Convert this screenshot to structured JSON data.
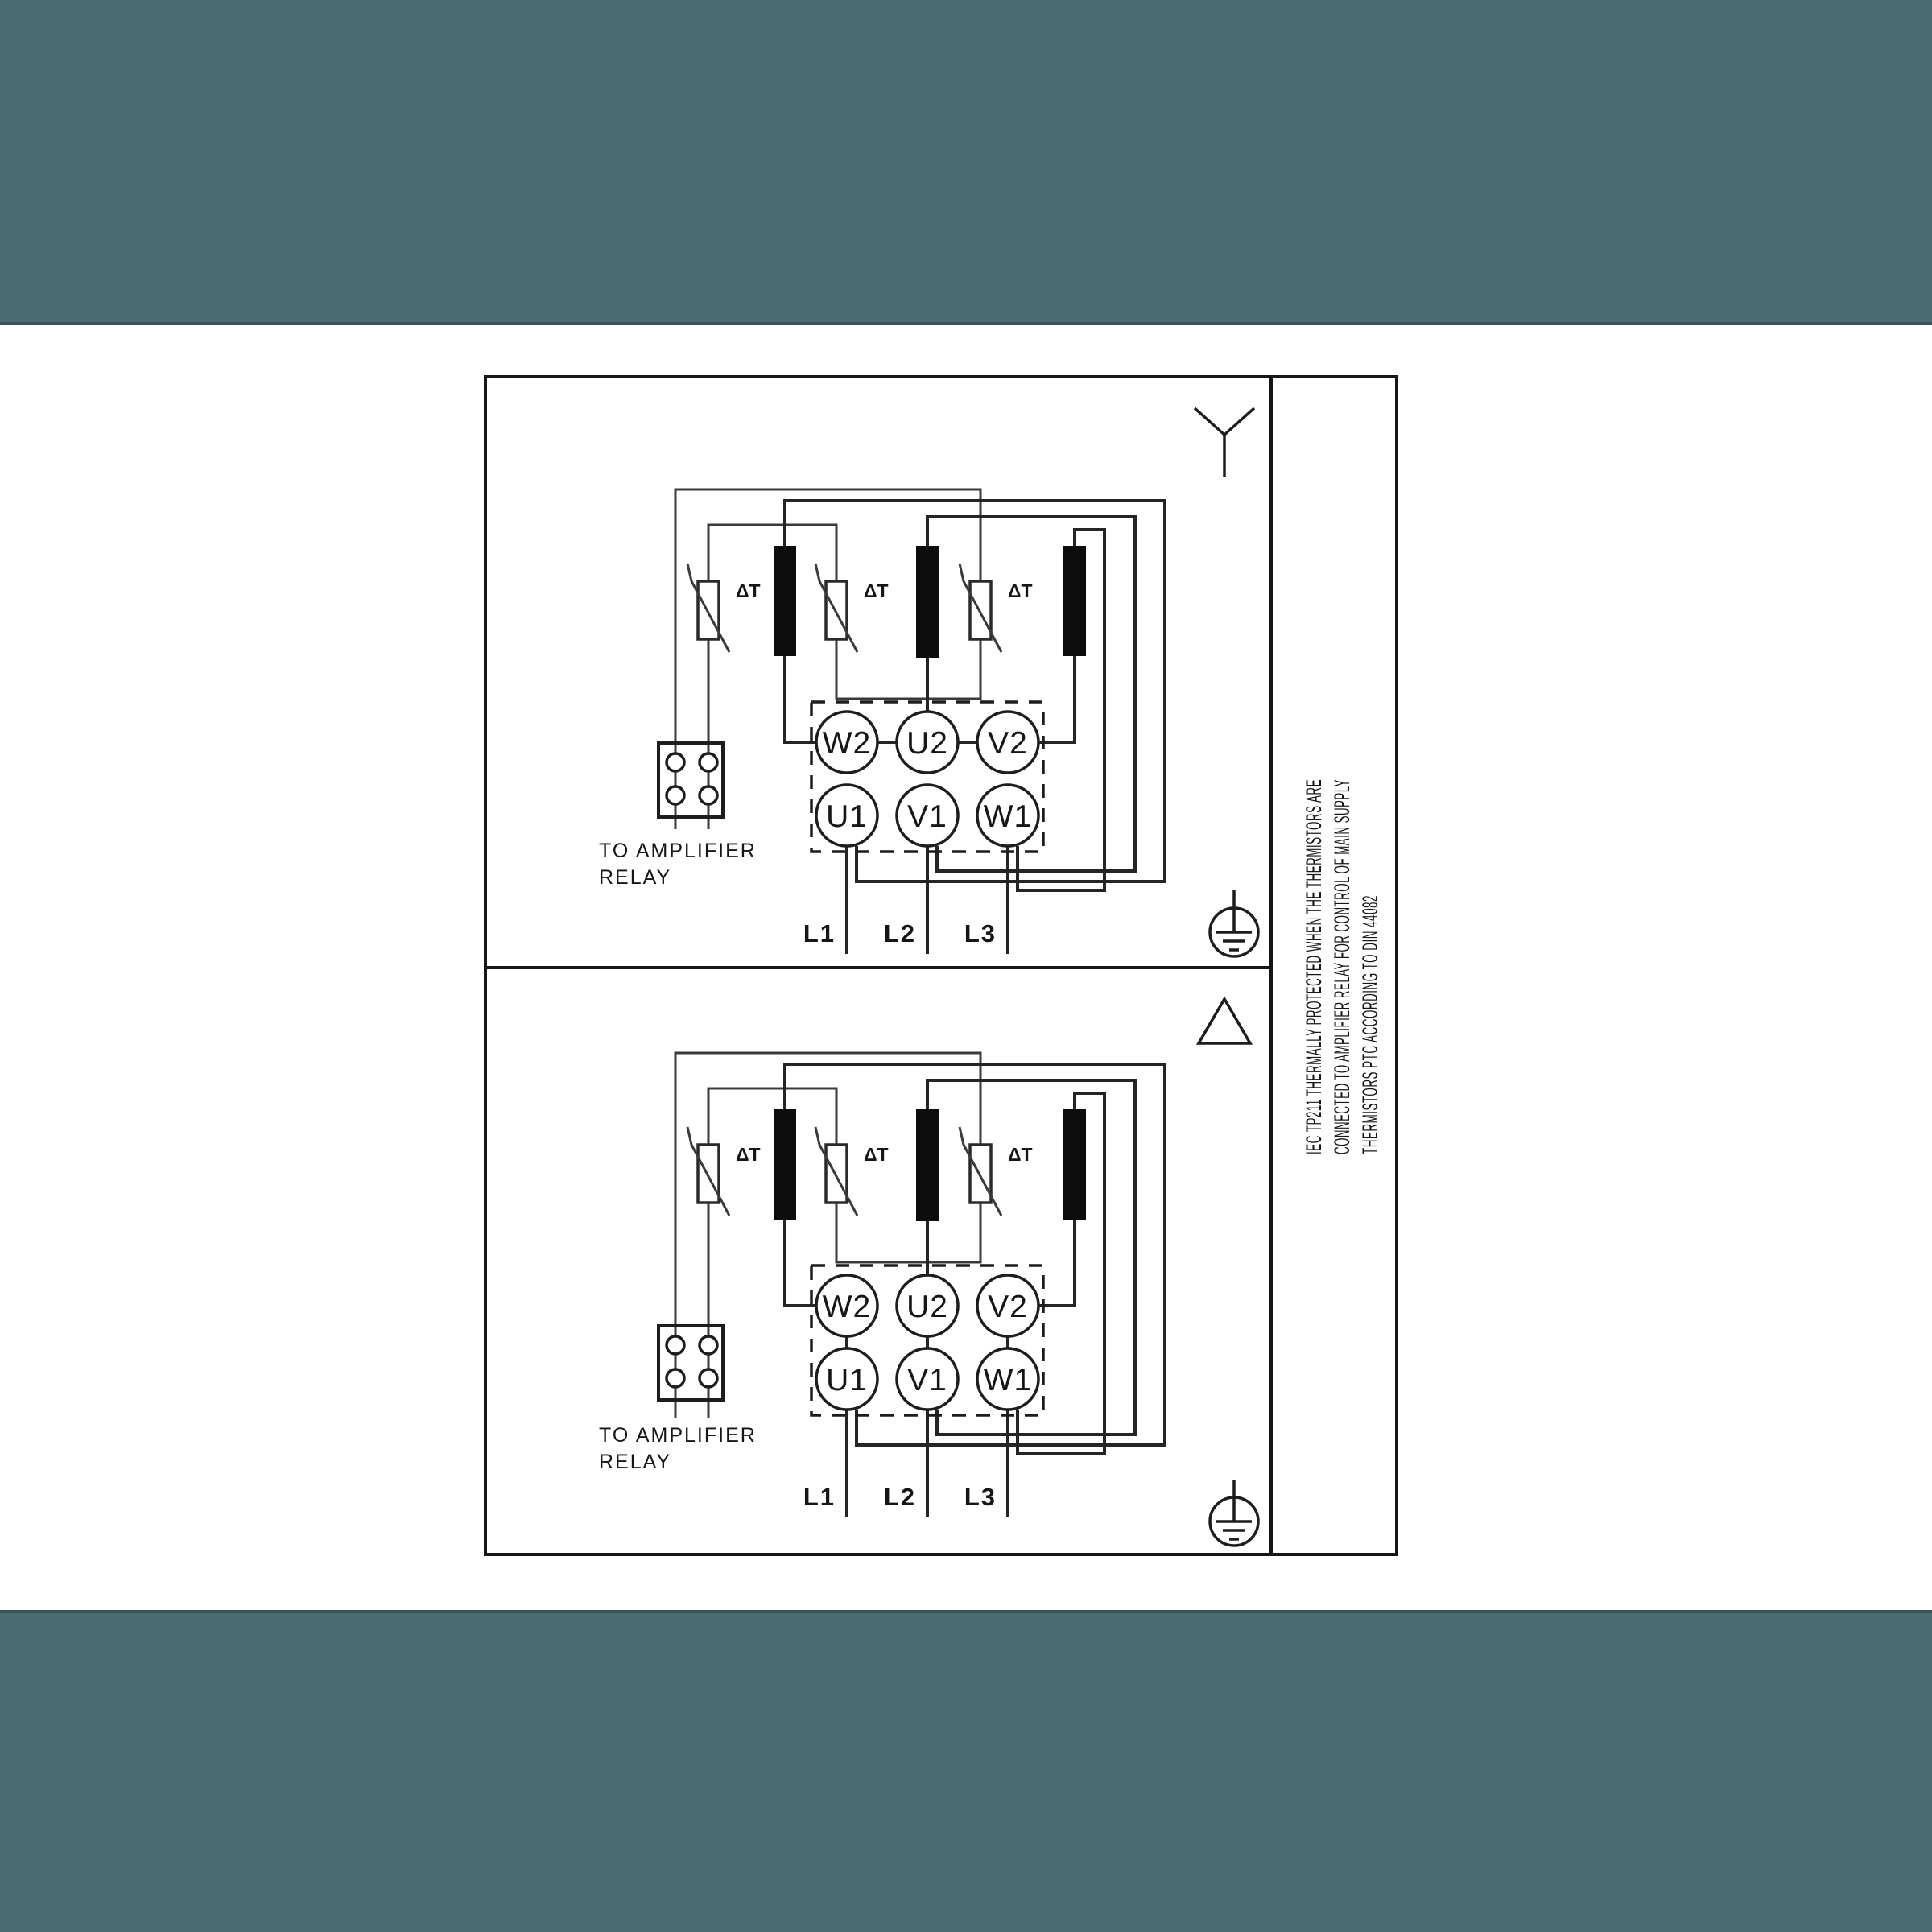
{
  "colors": {
    "band": "#4c6a72",
    "band_edge": "#3a545c",
    "ink": "#1c1c1c",
    "paper": "#ffffff"
  },
  "diagram": {
    "side_note": {
      "lines": [
        "IEC TP211 THERMALLY PROTECTED WHEN THE THERMISTORS ARE",
        "CONNECTED TO AMPLIFIER RELAY FOR CONTROL OF MAIN SUPPLY",
        "THERMISTORS PTC ACCORDING TO DIN 44082"
      ]
    },
    "panels": [
      {
        "name": "star",
        "connection_symbol": "star-icon",
        "terminals": {
          "top": [
            "W2",
            "U2",
            "V2"
          ],
          "bottom": [
            "U1",
            "V1",
            "W1"
          ]
        },
        "mains": [
          "L1",
          "L2",
          "L3"
        ],
        "thermistor_labels": [
          "ΔT",
          "ΔT",
          "ΔT"
        ],
        "note_lines": [
          "TO AMPLIFIER",
          "RELAY"
        ]
      },
      {
        "name": "delta",
        "connection_symbol": "delta-icon",
        "terminals": {
          "top": [
            "W2",
            "U2",
            "V2"
          ],
          "bottom": [
            "U1",
            "V1",
            "W1"
          ]
        },
        "mains": [
          "L1",
          "L2",
          "L3"
        ],
        "thermistor_labels": [
          "ΔT",
          "ΔT",
          "ΔT"
        ],
        "note_lines": [
          "TO AMPLIFIER",
          "RELAY"
        ]
      }
    ]
  }
}
